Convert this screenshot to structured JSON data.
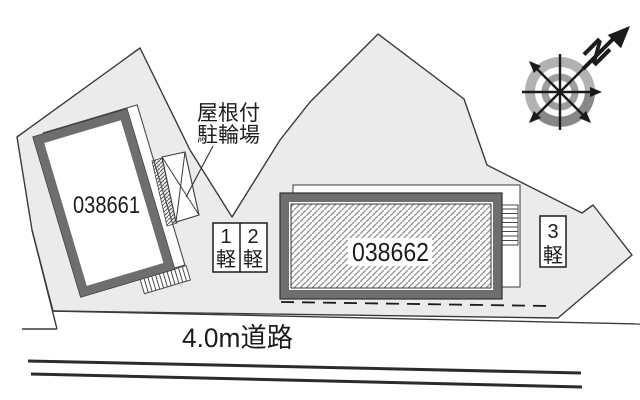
{
  "plan": {
    "buildings": [
      {
        "id": "left",
        "label": "038661"
      },
      {
        "id": "right",
        "label": "038662"
      }
    ],
    "bicycle_shed": {
      "label_line1": "屋根付",
      "label_line2": "駐輪場"
    },
    "parking_spots": [
      {
        "number": "1",
        "size_class": "軽"
      },
      {
        "number": "2",
        "size_class": "軽"
      },
      {
        "number": "3",
        "size_class": "軽"
      }
    ],
    "road": {
      "label": "4.0m道路"
    },
    "compass": {
      "north_label": "N"
    },
    "colors": {
      "parcel_fill": "#ebebeb",
      "building_frame": "#6e6e6e",
      "line": "#2b2b2b",
      "ring_light": "#b2b2b2",
      "ring_dark": "#878787"
    }
  }
}
